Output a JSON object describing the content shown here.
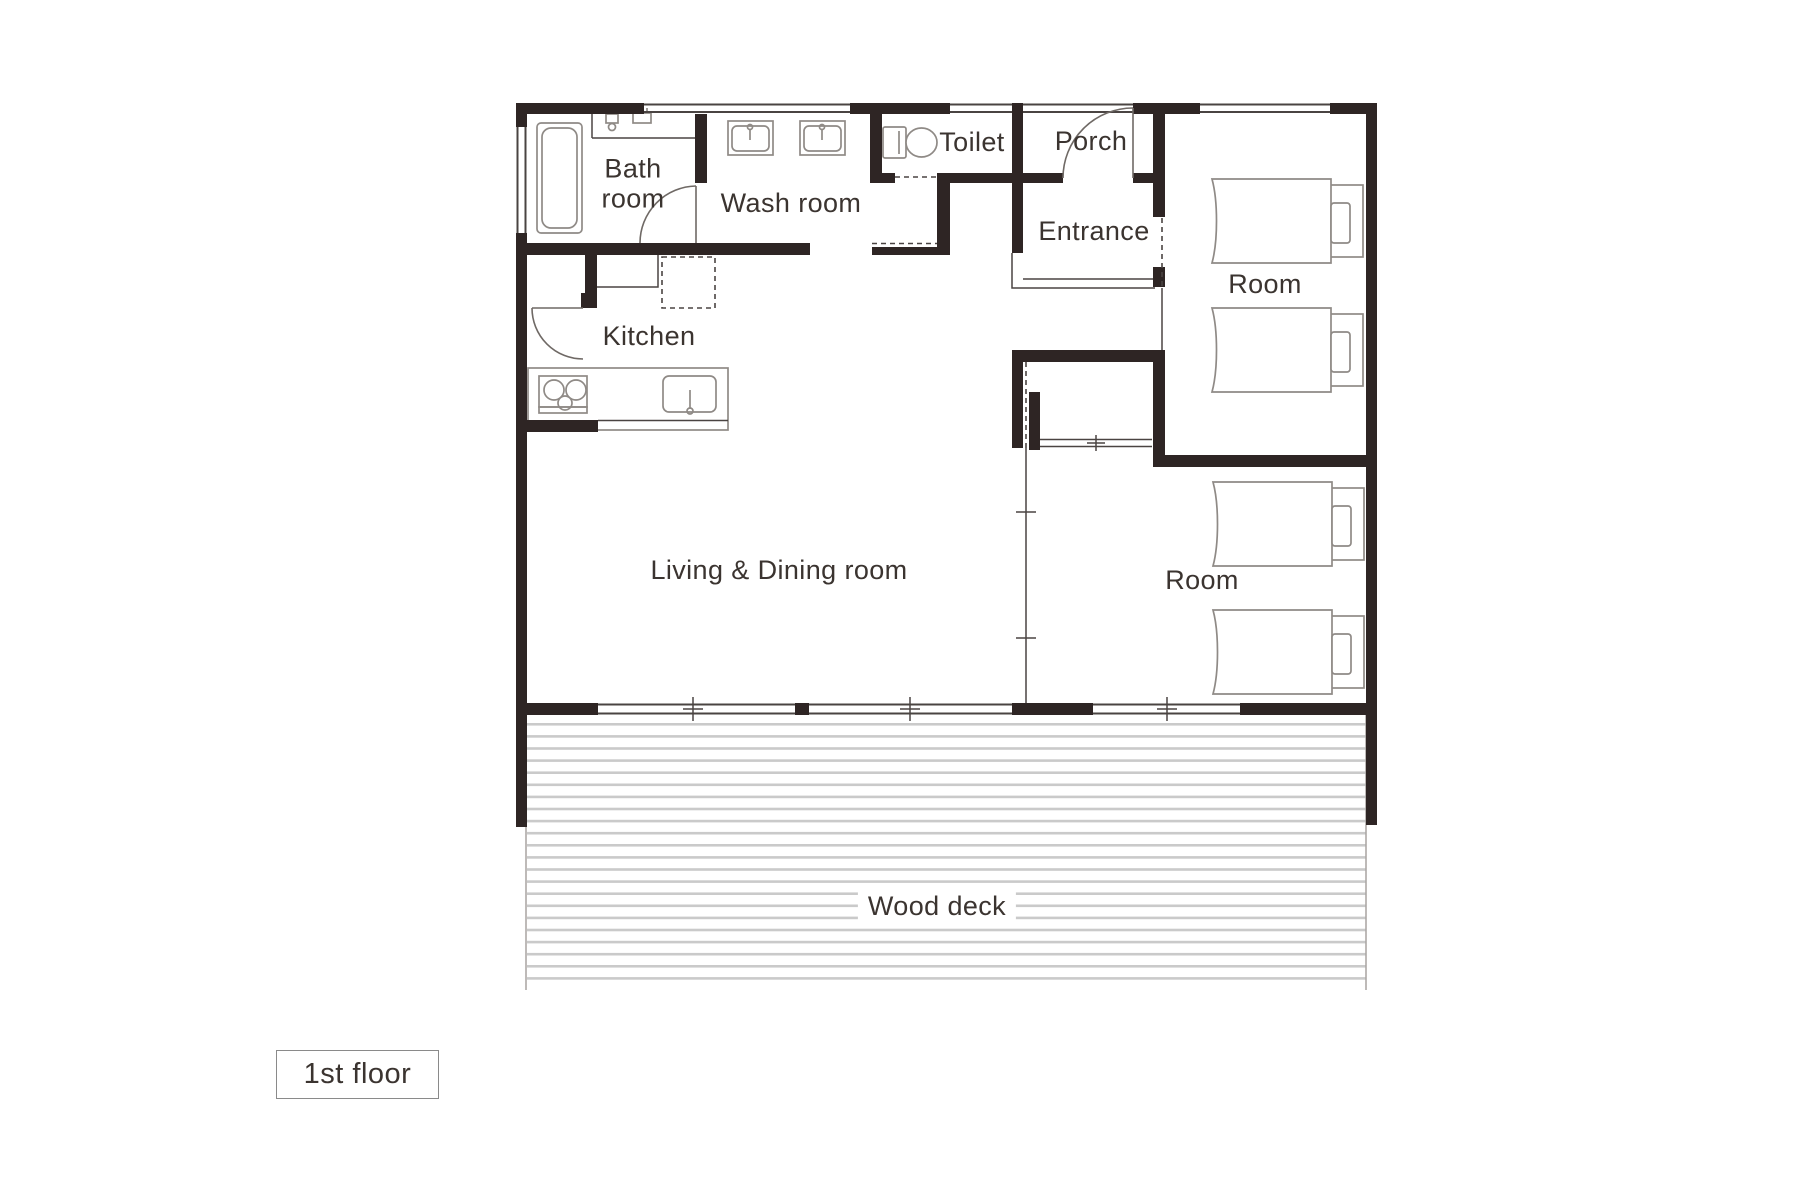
{
  "title": "1st floor",
  "colors": {
    "wall": "#2e2524",
    "text": "#3b3430",
    "line": "#4a4442",
    "fixture": "#8f8a86",
    "arc": "#6f6965",
    "stripe": "#cacaca",
    "stripe_edge": "#a8a4a1"
  },
  "rooms": {
    "bath_line1": "Bath",
    "bath_line2": "room",
    "wash": "Wash room",
    "toilet": "Toilet",
    "porch": "Porch",
    "entrance": "Entrance",
    "room_top": "Room",
    "kitchen": "Kitchen",
    "living": "Living & Dining room",
    "room_bottom": "Room",
    "deck": "Wood deck"
  },
  "deck_stripes": {
    "x": 527,
    "width": 839,
    "y_start": 723,
    "y_end": 989,
    "step": 12.1,
    "height": 2.6
  }
}
